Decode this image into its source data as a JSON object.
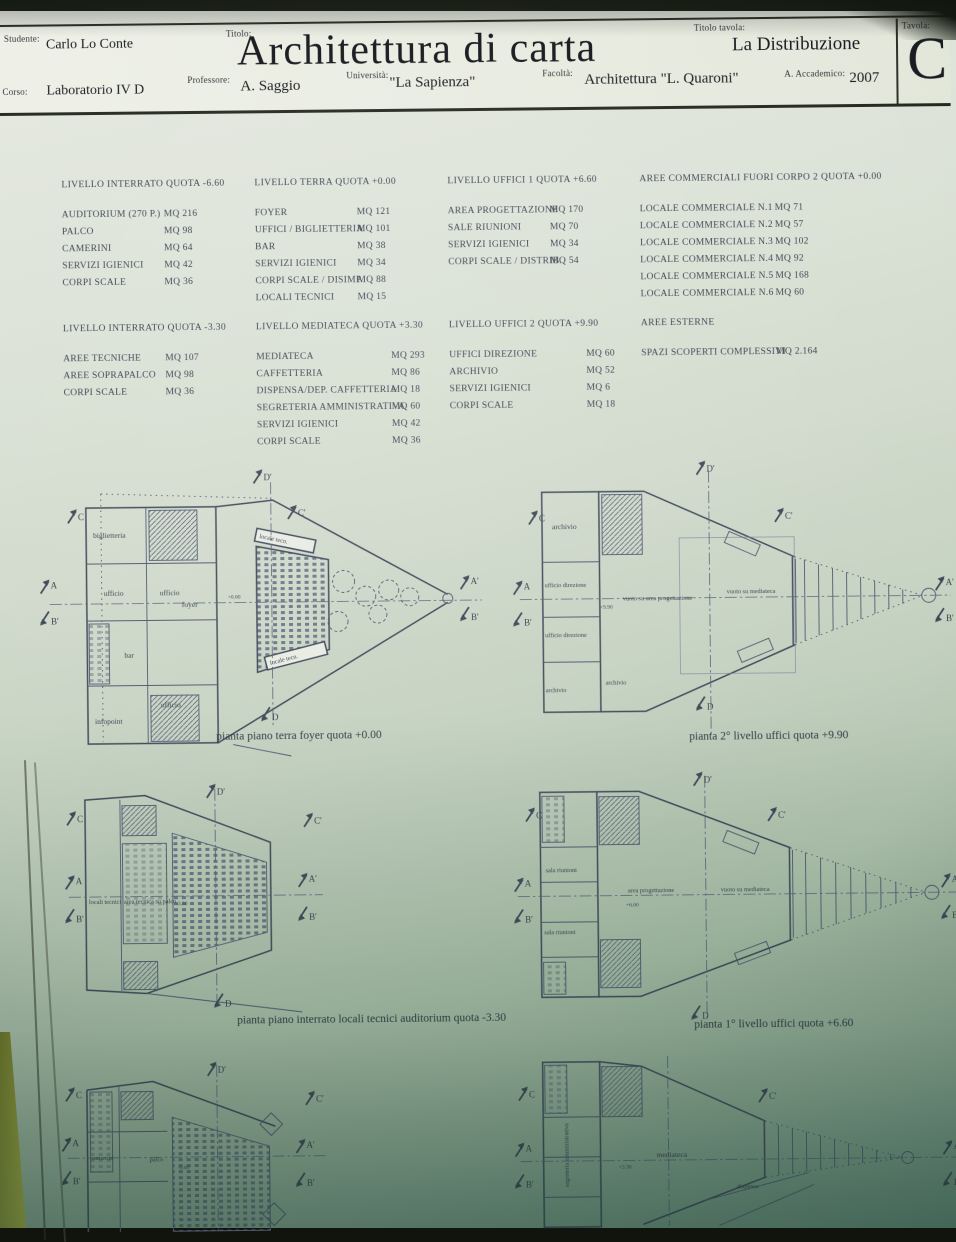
{
  "titleblock": {
    "studente_label": "Studente:",
    "studente": "Carlo  Lo Conte",
    "titolo_label": "Titolo:",
    "titolo": "Architettura di carta",
    "titolo_tavola_label": "Titolo tavola:",
    "titolo_tavola": "La Distribuzione",
    "tavola_label": "Tavola:",
    "tavola": "C",
    "corso_label": "Corso:",
    "corso": "Laboratorio IV D",
    "professore_label": "Professore:",
    "professore": "A. Saggio",
    "universita_label": "Università:",
    "universita": "\"La Sapienza\"",
    "facolta_label": "Facoltà:",
    "facolta": "Architettura \"L. Quaroni\"",
    "anno_label": "A. Accademico:",
    "anno": "2007"
  },
  "table_columns": [
    [
      {
        "title": "LIVELLO INTERRATO QUOTA -6.60",
        "rows": [
          [
            "AUDITORIUM (270 P.)",
            "MQ 216"
          ],
          [
            "PALCO",
            "MQ 98"
          ],
          [
            "CAMERINI",
            "MQ 64"
          ],
          [
            "SERVIZI IGIENICI",
            "MQ 42"
          ],
          [
            "CORPI SCALE",
            "MQ 36"
          ]
        ]
      },
      {
        "title": "LIVELLO INTERRATO QUOTA -3.30",
        "rows": [
          [
            "AREE TECNICHE",
            "MQ 107"
          ],
          [
            "AREE SOPRAPALCO",
            "MQ 98"
          ],
          [
            "CORPI SCALE",
            "MQ 36"
          ]
        ]
      }
    ],
    [
      {
        "title": "LIVELLO TERRA QUOTA +0.00",
        "rows": [
          [
            "FOYER",
            "MQ 121"
          ],
          [
            "UFFICI / BIGLIETTERIA",
            "MQ 101"
          ],
          [
            "BAR",
            "MQ 38"
          ],
          [
            "SERVIZI IGIENICI",
            "MQ 34"
          ],
          [
            "CORPI SCALE / DISIMP.",
            "MQ 88"
          ],
          [
            "LOCALI TECNICI",
            "MQ 15"
          ]
        ]
      },
      {
        "title": "LIVELLO MEDIATECA QUOTA +3.30",
        "rows": [
          [
            "MEDIATECA",
            "MQ 293"
          ],
          [
            "CAFFETTERIA",
            "MQ 86"
          ],
          [
            "DISPENSA/DEP. CAFFETTERIA",
            "MQ 18"
          ],
          [
            "SEGRETERIA AMMINISTRATIVA",
            "MQ 60"
          ],
          [
            "SERVIZI IGIENICI",
            "MQ 42"
          ],
          [
            "CORPI SCALE",
            "MQ 36"
          ]
        ]
      }
    ],
    [
      {
        "title": "LIVELLO UFFICI 1 QUOTA +6.60",
        "rows": [
          [
            "AREA PROGETTAZIONE",
            "MQ 170"
          ],
          [
            "SALE RIUNIONI",
            "MQ 70"
          ],
          [
            "SERVIZI IGIENICI",
            "MQ 34"
          ],
          [
            "CORPI SCALE / DISTRIB.",
            "MQ 54"
          ]
        ]
      },
      {
        "title": "LIVELLO UFFICI 2 QUOTA +9.90",
        "rows": [
          [
            "UFFICI DIREZIONE",
            "MQ 60"
          ],
          [
            "ARCHIVIO",
            "MQ 52"
          ],
          [
            "SERVIZI IGIENICI",
            "MQ 6"
          ],
          [
            "CORPI SCALE",
            "MQ 18"
          ]
        ]
      }
    ],
    [
      {
        "title": "AREE COMMERCIALI FUORI CORPO 2 QUOTA +0.00",
        "rows": [
          [
            "LOCALE COMMERCIALE N.1",
            "MQ 71"
          ],
          [
            "LOCALE COMMERCIALE N.2",
            "MQ 57"
          ],
          [
            "LOCALE COMMERCIALE N.3",
            "MQ 102"
          ],
          [
            "LOCALE COMMERCIALE N.4",
            "MQ 92"
          ],
          [
            "LOCALE COMMERCIALE N.5",
            "MQ 168"
          ],
          [
            "LOCALE COMMERCIALE N.6",
            "MQ 60"
          ]
        ]
      },
      {
        "title": "AREE ESTERNE",
        "rows": [
          [
            "SPAZI SCOPERTI COMPLESSIVI",
            "MQ 2.164"
          ]
        ]
      }
    ]
  ],
  "section_markers": {
    "c": "C",
    "c1": "C'",
    "a": "A",
    "a1": "A'",
    "b1": "B'",
    "d": "D",
    "d1": "D'"
  },
  "plans": [
    {
      "caption": "pianta piano terra  foyer quota +0.00",
      "quota": "+0.00",
      "labels": [
        "biglietteria",
        "ufficio",
        "ufficio",
        "bar",
        "foyer",
        "locale tecn.",
        "locale tecn.",
        "ufficio",
        "infopoint"
      ]
    },
    {
      "caption": "pianta  2° livello uffici quota +9.90",
      "quota": "+9.90",
      "labels": [
        "archivio",
        "ufficio direzione",
        "ufficio direzione",
        "archivio",
        "archivio",
        "vuoto su area progettazione",
        "vuoto su mediateca"
      ]
    },
    {
      "caption": "pianta piano interrato locali tecnici auditorium quota -3.30",
      "quota": "-3.30",
      "labels": [
        "locali tecnici",
        "area tecnica su palco"
      ]
    },
    {
      "caption": "pianta 1° livello uffici quota +6.60",
      "quota": "+6.60",
      "labels": [
        "sala riunioni",
        "sala riunioni",
        "area progettazione",
        "vuoto su mediateca"
      ]
    },
    {
      "quota": "-6.60",
      "labels": [
        "camerini",
        "palco"
      ]
    },
    {
      "quota": "+3.30",
      "labels": [
        "segreteria amministrativa",
        "mediateca",
        "dispensa"
      ]
    }
  ]
}
